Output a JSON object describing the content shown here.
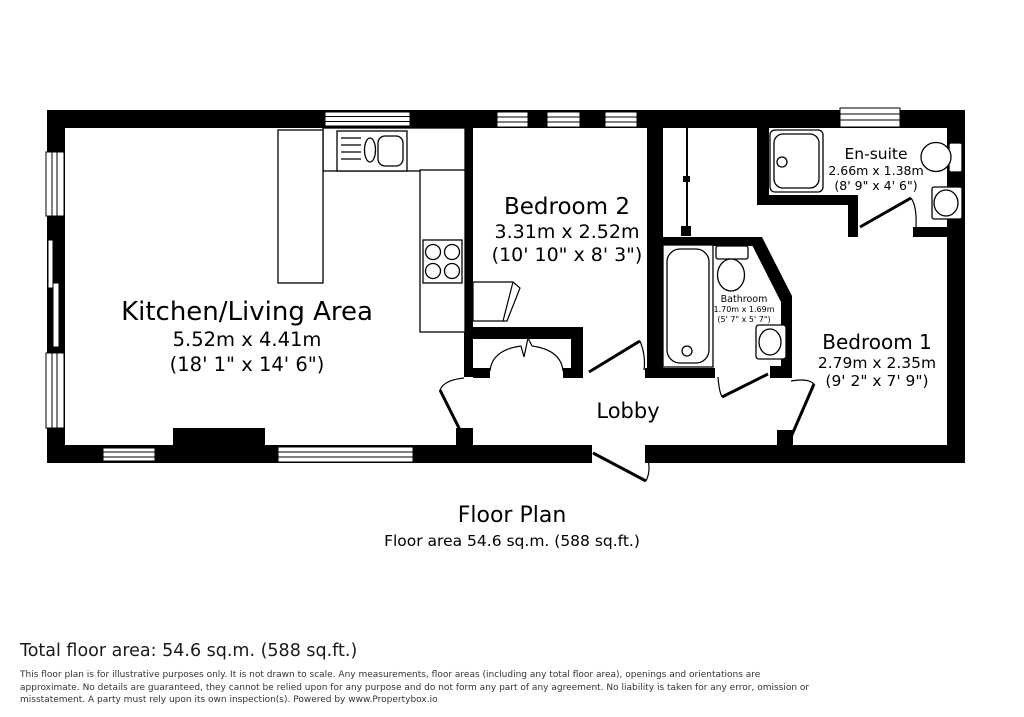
{
  "rooms": {
    "kitchen_living": {
      "name": "Kitchen/Living Area",
      "dims_metric": "5.52m x 4.41m",
      "dims_imperial": "(18' 1\" x 14' 6\")"
    },
    "bedroom_2": {
      "name": "Bedroom 2",
      "dims_metric": "3.31m x 2.52m",
      "dims_imperial": "(10' 10\" x 8' 3\")"
    },
    "en_suite": {
      "name": "En-suite",
      "dims_metric": "2.66m x 1.38m",
      "dims_imperial": "(8' 9\" x 4' 6\")"
    },
    "bathroom": {
      "name": "Bathroom",
      "dims_metric": "1.70m x 1.69m",
      "dims_imperial": "(5' 7\" x 5' 7\")"
    },
    "bedroom_1": {
      "name": "Bedroom 1",
      "dims_metric": "2.79m x 2.35m",
      "dims_imperial": "(9' 2\" x 7' 9\")"
    },
    "lobby": {
      "name": "Lobby"
    }
  },
  "caption": {
    "title": "Floor Plan",
    "subtitle": "Floor area 54.6 sq.m. (588 sq.ft.)"
  },
  "footer": {
    "total_area": "Total floor area: 54.6 sq.m. (588 sq.ft.)",
    "disclaimer_lines": [
      "This floor plan is for illustrative purposes only. It is not drawn to scale. Any measurements, floor areas (including any total floor area), openings and orientations are",
      "approximate. No details are guaranteed, they cannot be relied upon for any purpose and do not form any part of any agreement. No liability is taken for any error, omission or",
      "misstatement. A party must rely upon its own inspection(s). Powered by www.Propertybox.io"
    ]
  },
  "colors": {
    "wall": "#000000",
    "background": "#ffffff",
    "text": "#000000"
  }
}
